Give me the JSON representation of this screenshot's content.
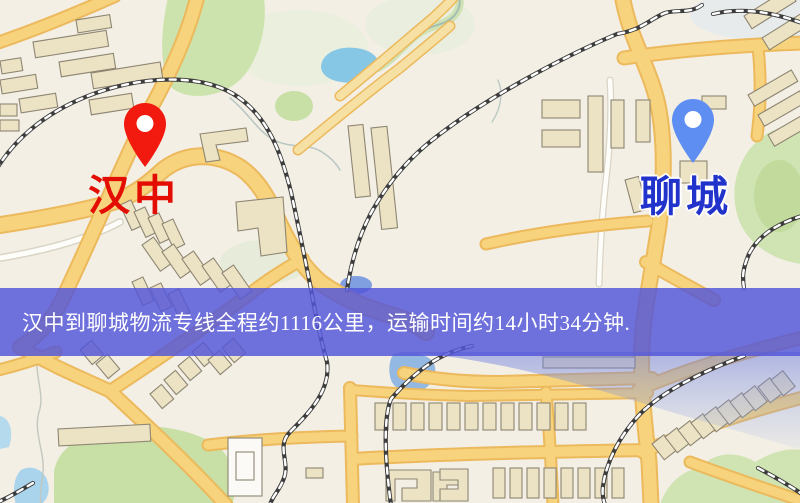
{
  "map": {
    "kind": "stylized street map",
    "origin": {
      "label": "汉中",
      "pin_color": "#f2190e",
      "label_color": "#e30d03"
    },
    "destination": {
      "label": "聊城",
      "pin_color": "#5f8ef3",
      "label_color": "#2233cc"
    }
  },
  "banner": {
    "text": "汉中到聊城物流专线全程约1116公里，运输时间约14小时34分钟.",
    "route_distance_text": "约1116公里",
    "route_duration_text": "约14小时34分钟",
    "background_color": "#5356d8",
    "text_color": "#ffffff"
  },
  "palette": {
    "map_background": "#f3efe5",
    "road_fill": "#f6d37c",
    "road_casing": "#ecb95c",
    "building_fill": "#ece2c4",
    "building_stroke": "#8e8673",
    "park_green": "#cde3ae",
    "lake_blue": "#87c7e6",
    "railway_dark": "#3d3d3d",
    "overlay_wash": "#6878de"
  }
}
